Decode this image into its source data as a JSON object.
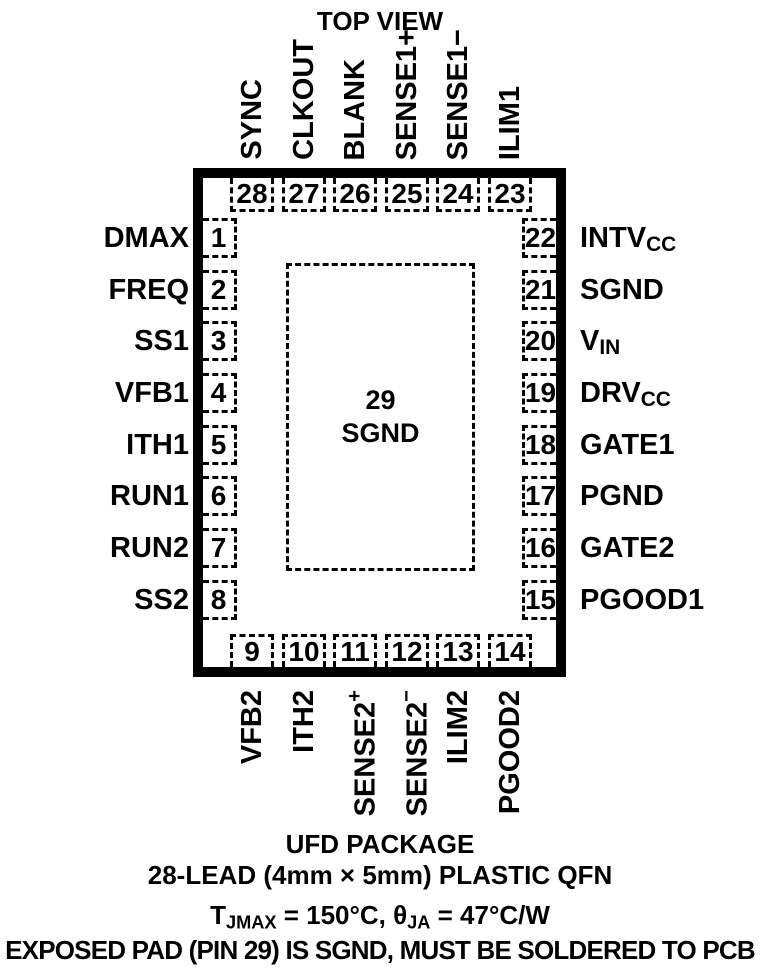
{
  "title": "TOP VIEW",
  "package": {
    "center_pad": {
      "number": "29",
      "name": "SGND"
    },
    "top_pins": [
      {
        "num": "28",
        "label": {
          "base": "SYNC"
        }
      },
      {
        "num": "27",
        "label": {
          "base": "CLKOUT"
        }
      },
      {
        "num": "26",
        "label": {
          "base": "BLANK"
        }
      },
      {
        "num": "25",
        "label": {
          "base": "SENSE1+"
        }
      },
      {
        "num": "24",
        "label": {
          "base": "SENSE1−"
        }
      },
      {
        "num": "23",
        "label": {
          "base": "ILIM1"
        }
      }
    ],
    "left_pins": [
      {
        "num": "1",
        "label": {
          "base": "DMAX"
        }
      },
      {
        "num": "2",
        "label": {
          "base": "FREQ"
        }
      },
      {
        "num": "3",
        "label": {
          "base": "SS1"
        }
      },
      {
        "num": "4",
        "label": {
          "base": "VFB1"
        }
      },
      {
        "num": "5",
        "label": {
          "base": "ITH1"
        }
      },
      {
        "num": "6",
        "label": {
          "base": "RUN1"
        }
      },
      {
        "num": "7",
        "label": {
          "base": "RUN2"
        }
      },
      {
        "num": "8",
        "label": {
          "base": "SS2"
        }
      }
    ],
    "right_pins": [
      {
        "num": "22",
        "label": {
          "base": "INTV",
          "sub": "CC"
        }
      },
      {
        "num": "21",
        "label": {
          "base": "SGND"
        }
      },
      {
        "num": "20",
        "label": {
          "base": "V",
          "sub": "IN"
        }
      },
      {
        "num": "19",
        "label": {
          "base": "DRV",
          "sub": "CC"
        }
      },
      {
        "num": "18",
        "label": {
          "base": "GATE1"
        }
      },
      {
        "num": "17",
        "label": {
          "base": "PGND"
        }
      },
      {
        "num": "16",
        "label": {
          "base": "GATE2"
        }
      },
      {
        "num": "15",
        "label": {
          "base": "PGOOD1"
        }
      }
    ],
    "bottom_pins": [
      {
        "num": "9",
        "label": {
          "base": "VFB2"
        }
      },
      {
        "num": "10",
        "label": {
          "base": "ITH2"
        }
      },
      {
        "num": "11",
        "label": {
          "base": "SENSE2",
          "sup": "+"
        }
      },
      {
        "num": "12",
        "label": {
          "base": "SENSE2",
          "sup": "−"
        }
      },
      {
        "num": "13",
        "label": {
          "base": "ILIM2"
        }
      },
      {
        "num": "14",
        "label": {
          "base": "PGOOD2"
        }
      }
    ]
  },
  "footer": {
    "package_name": "UFD PACKAGE",
    "package_desc": "28-LEAD (4mm × 5mm) PLASTIC QFN",
    "thermal": {
      "t": "T",
      "t_sub": "JMAX",
      "mid": " = 150°C, θ",
      "theta_sub": "JA",
      "tail": " = 47°C/W"
    },
    "note": "EXPOSED PAD (PIN 29) IS SGND, MUST BE SOLDERED TO PCB"
  },
  "colors": {
    "ink": "#000000",
    "paper": "#ffffff"
  }
}
